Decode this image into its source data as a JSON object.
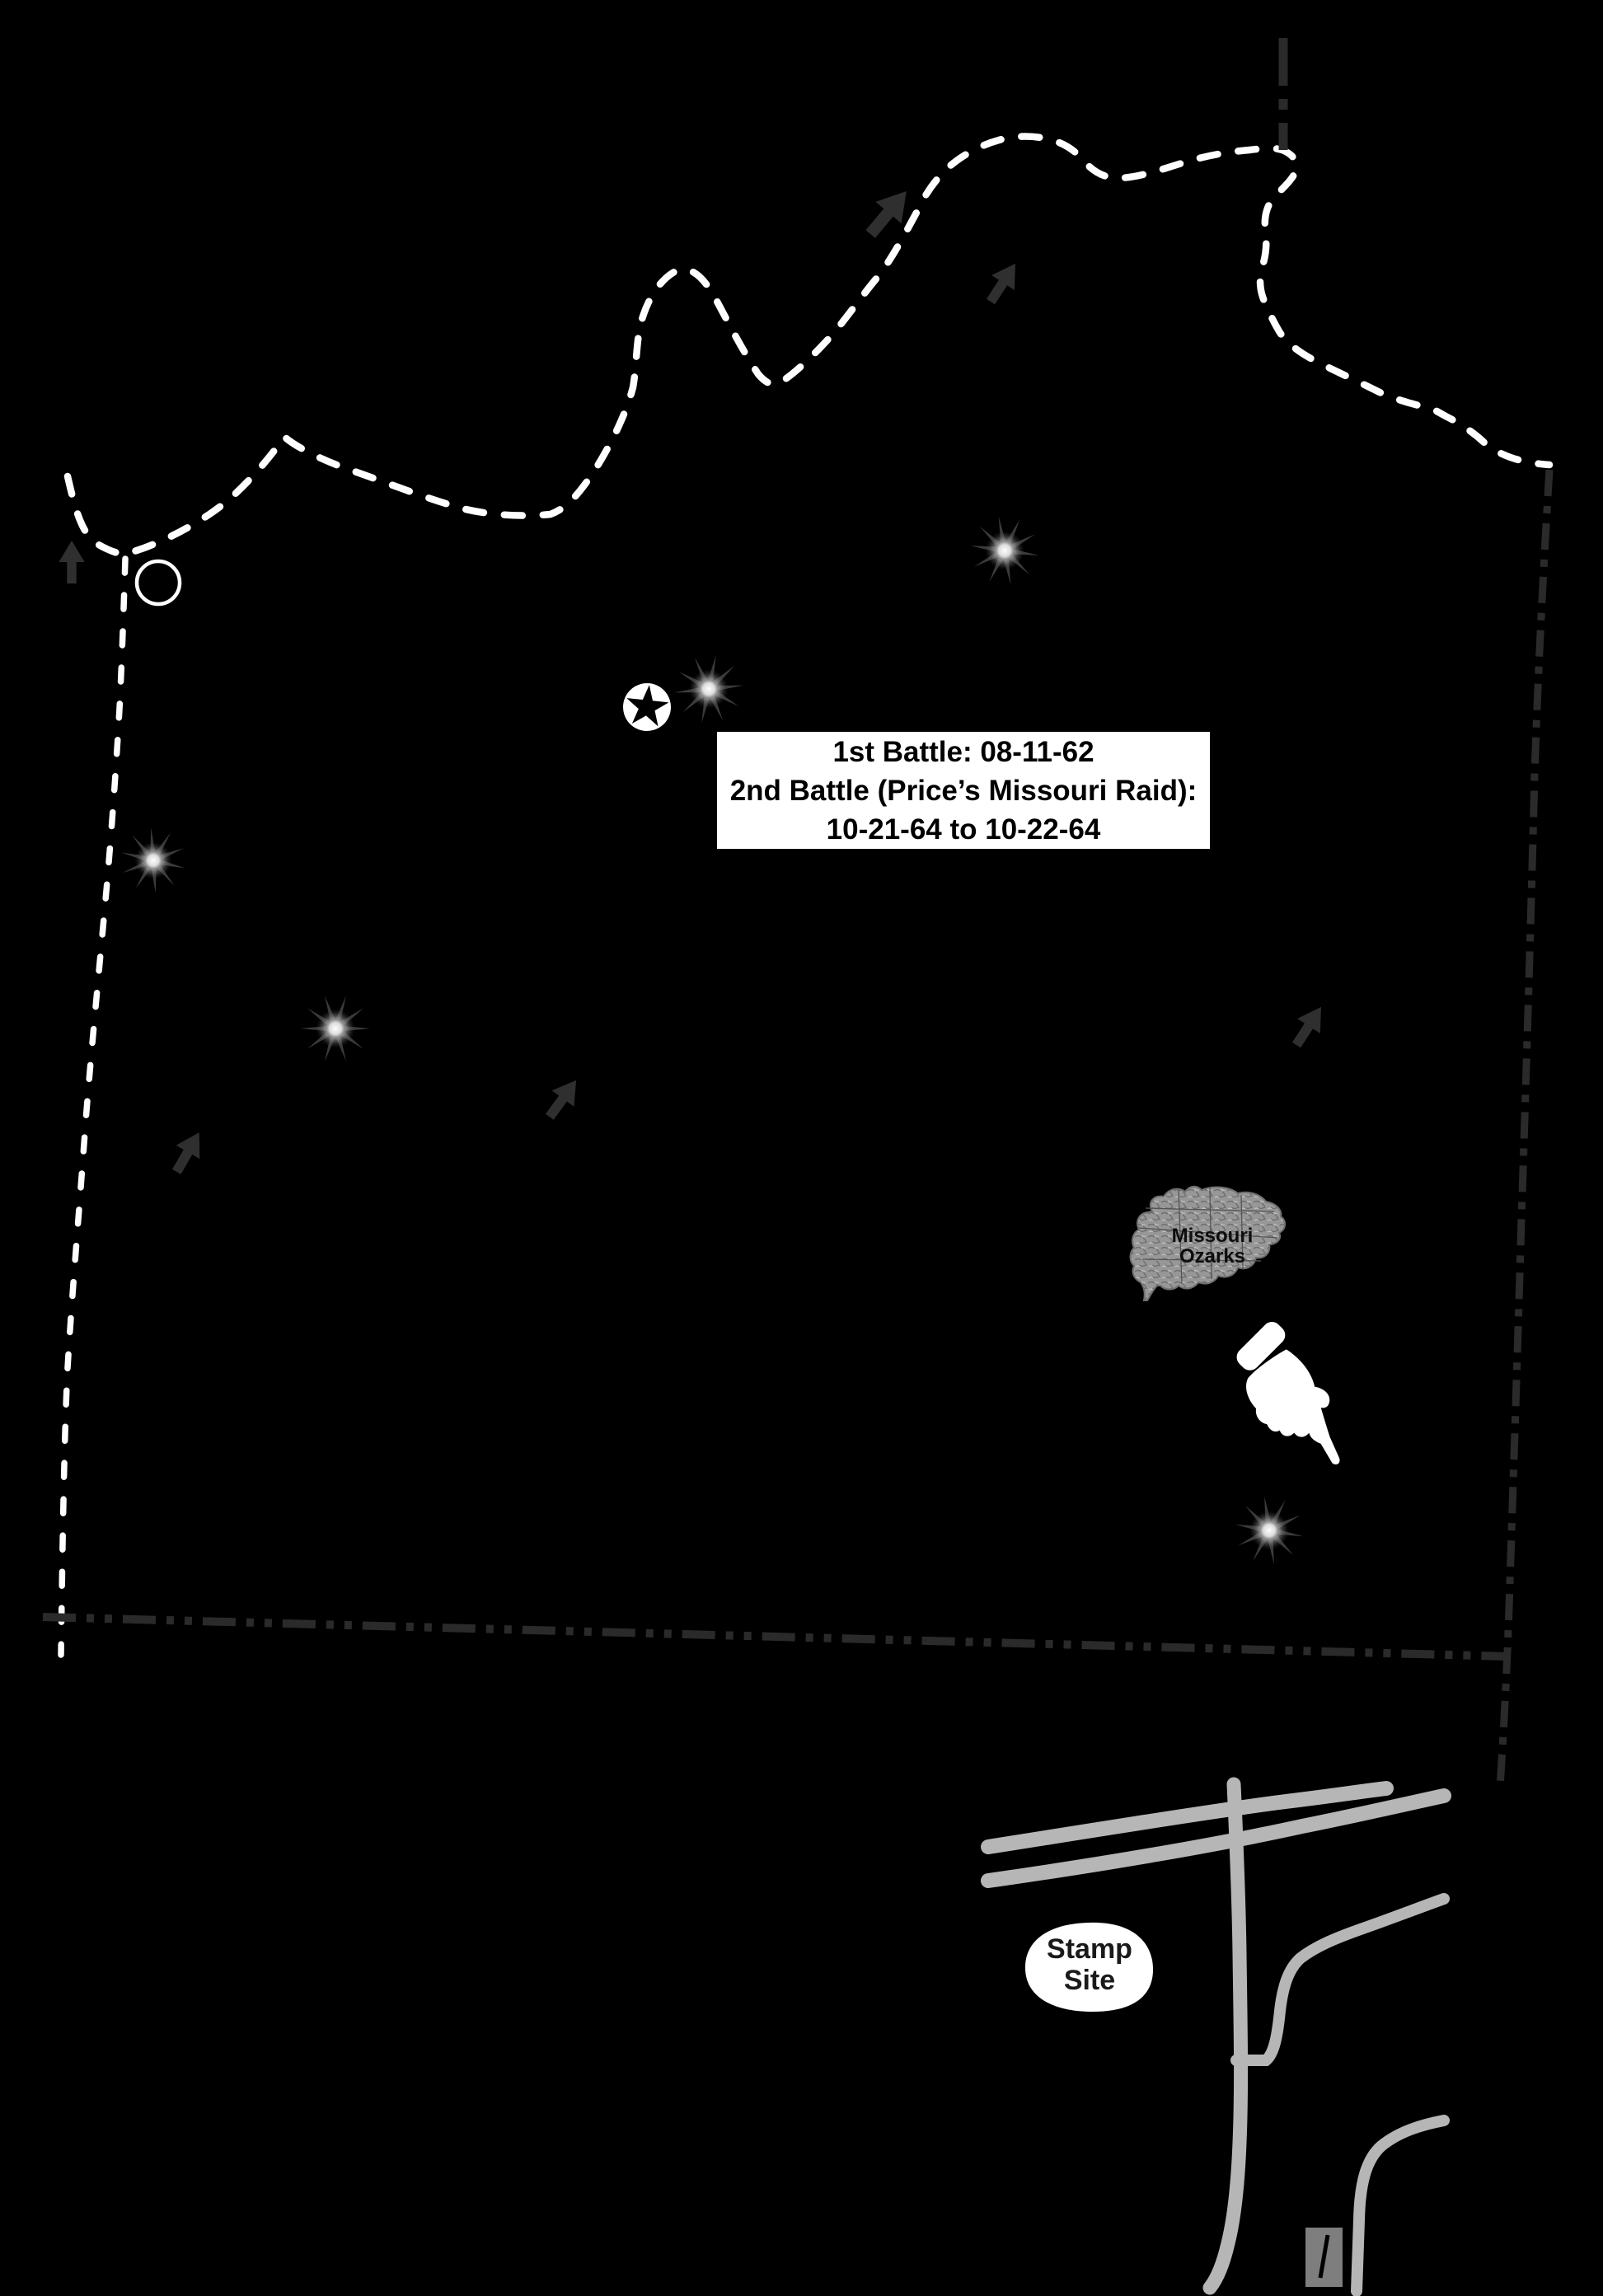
{
  "page": {
    "background": "#000000"
  },
  "battle_info_box": {
    "line1": "1st Battle: 08-11-62",
    "line2": "2nd Battle (Price’s Missouri Raid):",
    "line3": "10-21-64 to 10-22-64",
    "bg": "#ffffff",
    "text_color": "#000000"
  },
  "inset_map": {
    "label_line1": "Missouri",
    "label_line2": "Ozarks",
    "fill": "#989898"
  },
  "stamp_site": {
    "label_line1": "Stamp",
    "label_line2": "Site",
    "bg": "#ffffff"
  },
  "colors": {
    "river_dashed": "#ffffff",
    "county_line_white": "#ffffff",
    "county_line_dark": "#2a2a2a",
    "road": "#b6b6b6",
    "arrow": "#2f2f2f",
    "building": "#7e7e7e",
    "marker_white": "#ffffff",
    "starburst_spikes": "#3a3a3a"
  },
  "icons": {
    "battle_sites": "starburst-icon",
    "city_marker": "circled-star-icon",
    "river_junction": "circle-outline-icon",
    "flow_direction": "arrow-up-icon",
    "stamp_pointer": "pointing-hand-icon"
  }
}
